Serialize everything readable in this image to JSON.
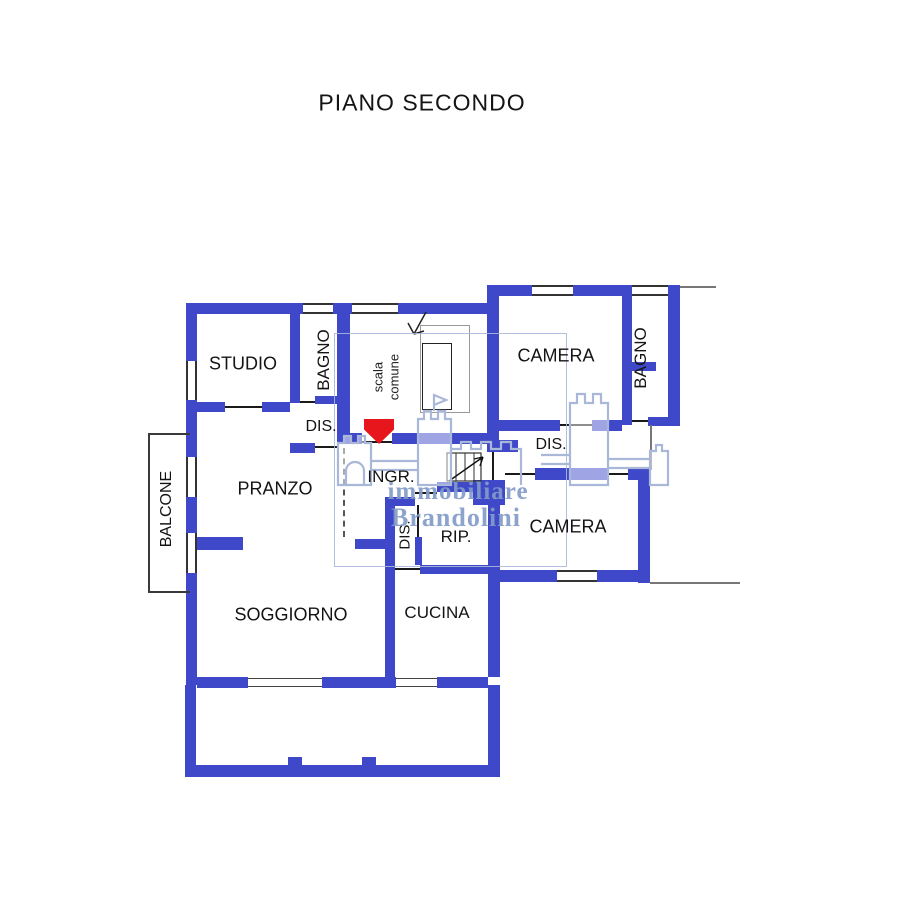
{
  "page": {
    "title": "PIANO SECONDO"
  },
  "floor_plan": {
    "rooms": {
      "studio": "STUDIO",
      "bagno1": "BAGNO",
      "scala": [
        "scala",
        "comune"
      ],
      "camera1": "CAMERA",
      "bagno2": "BAGNO",
      "dis1": "DIS.",
      "dis2": "DIS.",
      "ingr": "INGR.",
      "pranzo": "PRANZO",
      "dis3": "DIS.",
      "rip": "RIP.",
      "camera2": "CAMERA",
      "balcone": "BALCONE",
      "soggiorno": "SOGGIORNO",
      "cucina": "CUCINA"
    },
    "watermark": {
      "line1": "immobiliare",
      "line2": "Brandolini"
    },
    "colors": {
      "wall": "#3E48C8",
      "watermark": "#A9B7D9",
      "watermark_text": "#8296C8",
      "entrance_arrow": "#E6161C"
    }
  }
}
